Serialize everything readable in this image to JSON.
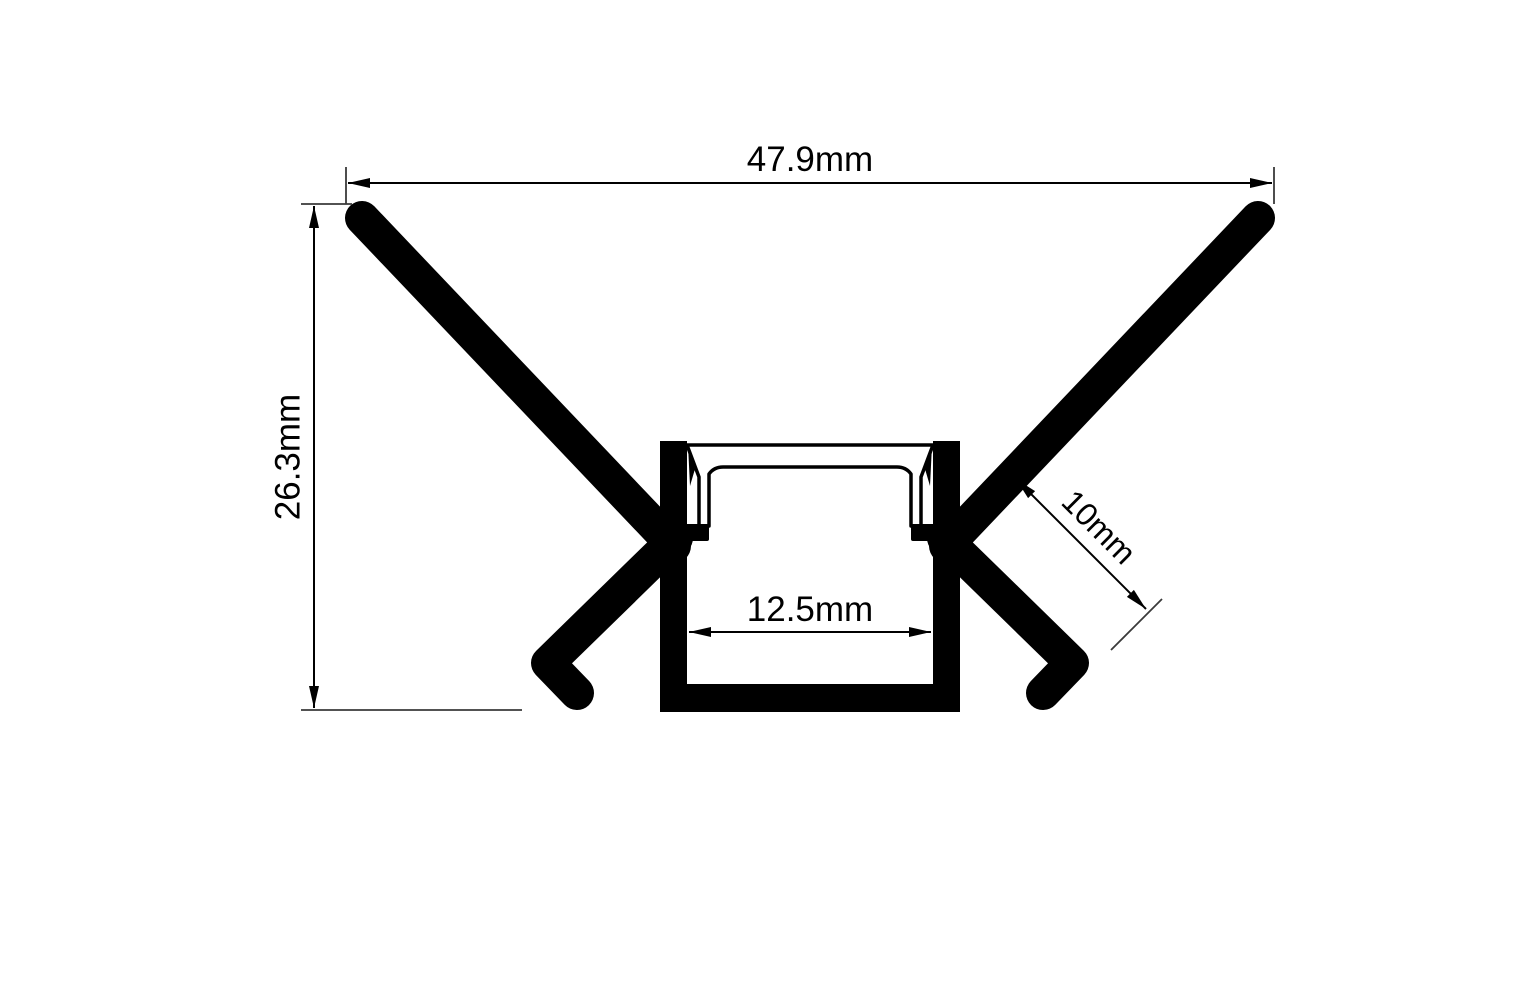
{
  "drawing": {
    "type": "technical-cross-section",
    "subject": "Recessed trimless LED aluminium profile with diffuser cover",
    "background_color": "#ffffff",
    "line_color": "#000000",
    "dimensions": {
      "overall_width": {
        "label": "47.9mm",
        "value_mm": 47.9,
        "orientation": "horizontal",
        "position": "top"
      },
      "overall_height": {
        "label": "26.3mm",
        "value_mm": 26.3,
        "orientation": "vertical",
        "position": "left"
      },
      "inner_width": {
        "label": "12.5mm",
        "value_mm": 12.5,
        "orientation": "horizontal",
        "position": "inside-channel"
      },
      "flange_gap": {
        "label": "10mm",
        "value_mm": 10,
        "orientation": "diagonal-45deg",
        "position": "right"
      }
    }
  }
}
